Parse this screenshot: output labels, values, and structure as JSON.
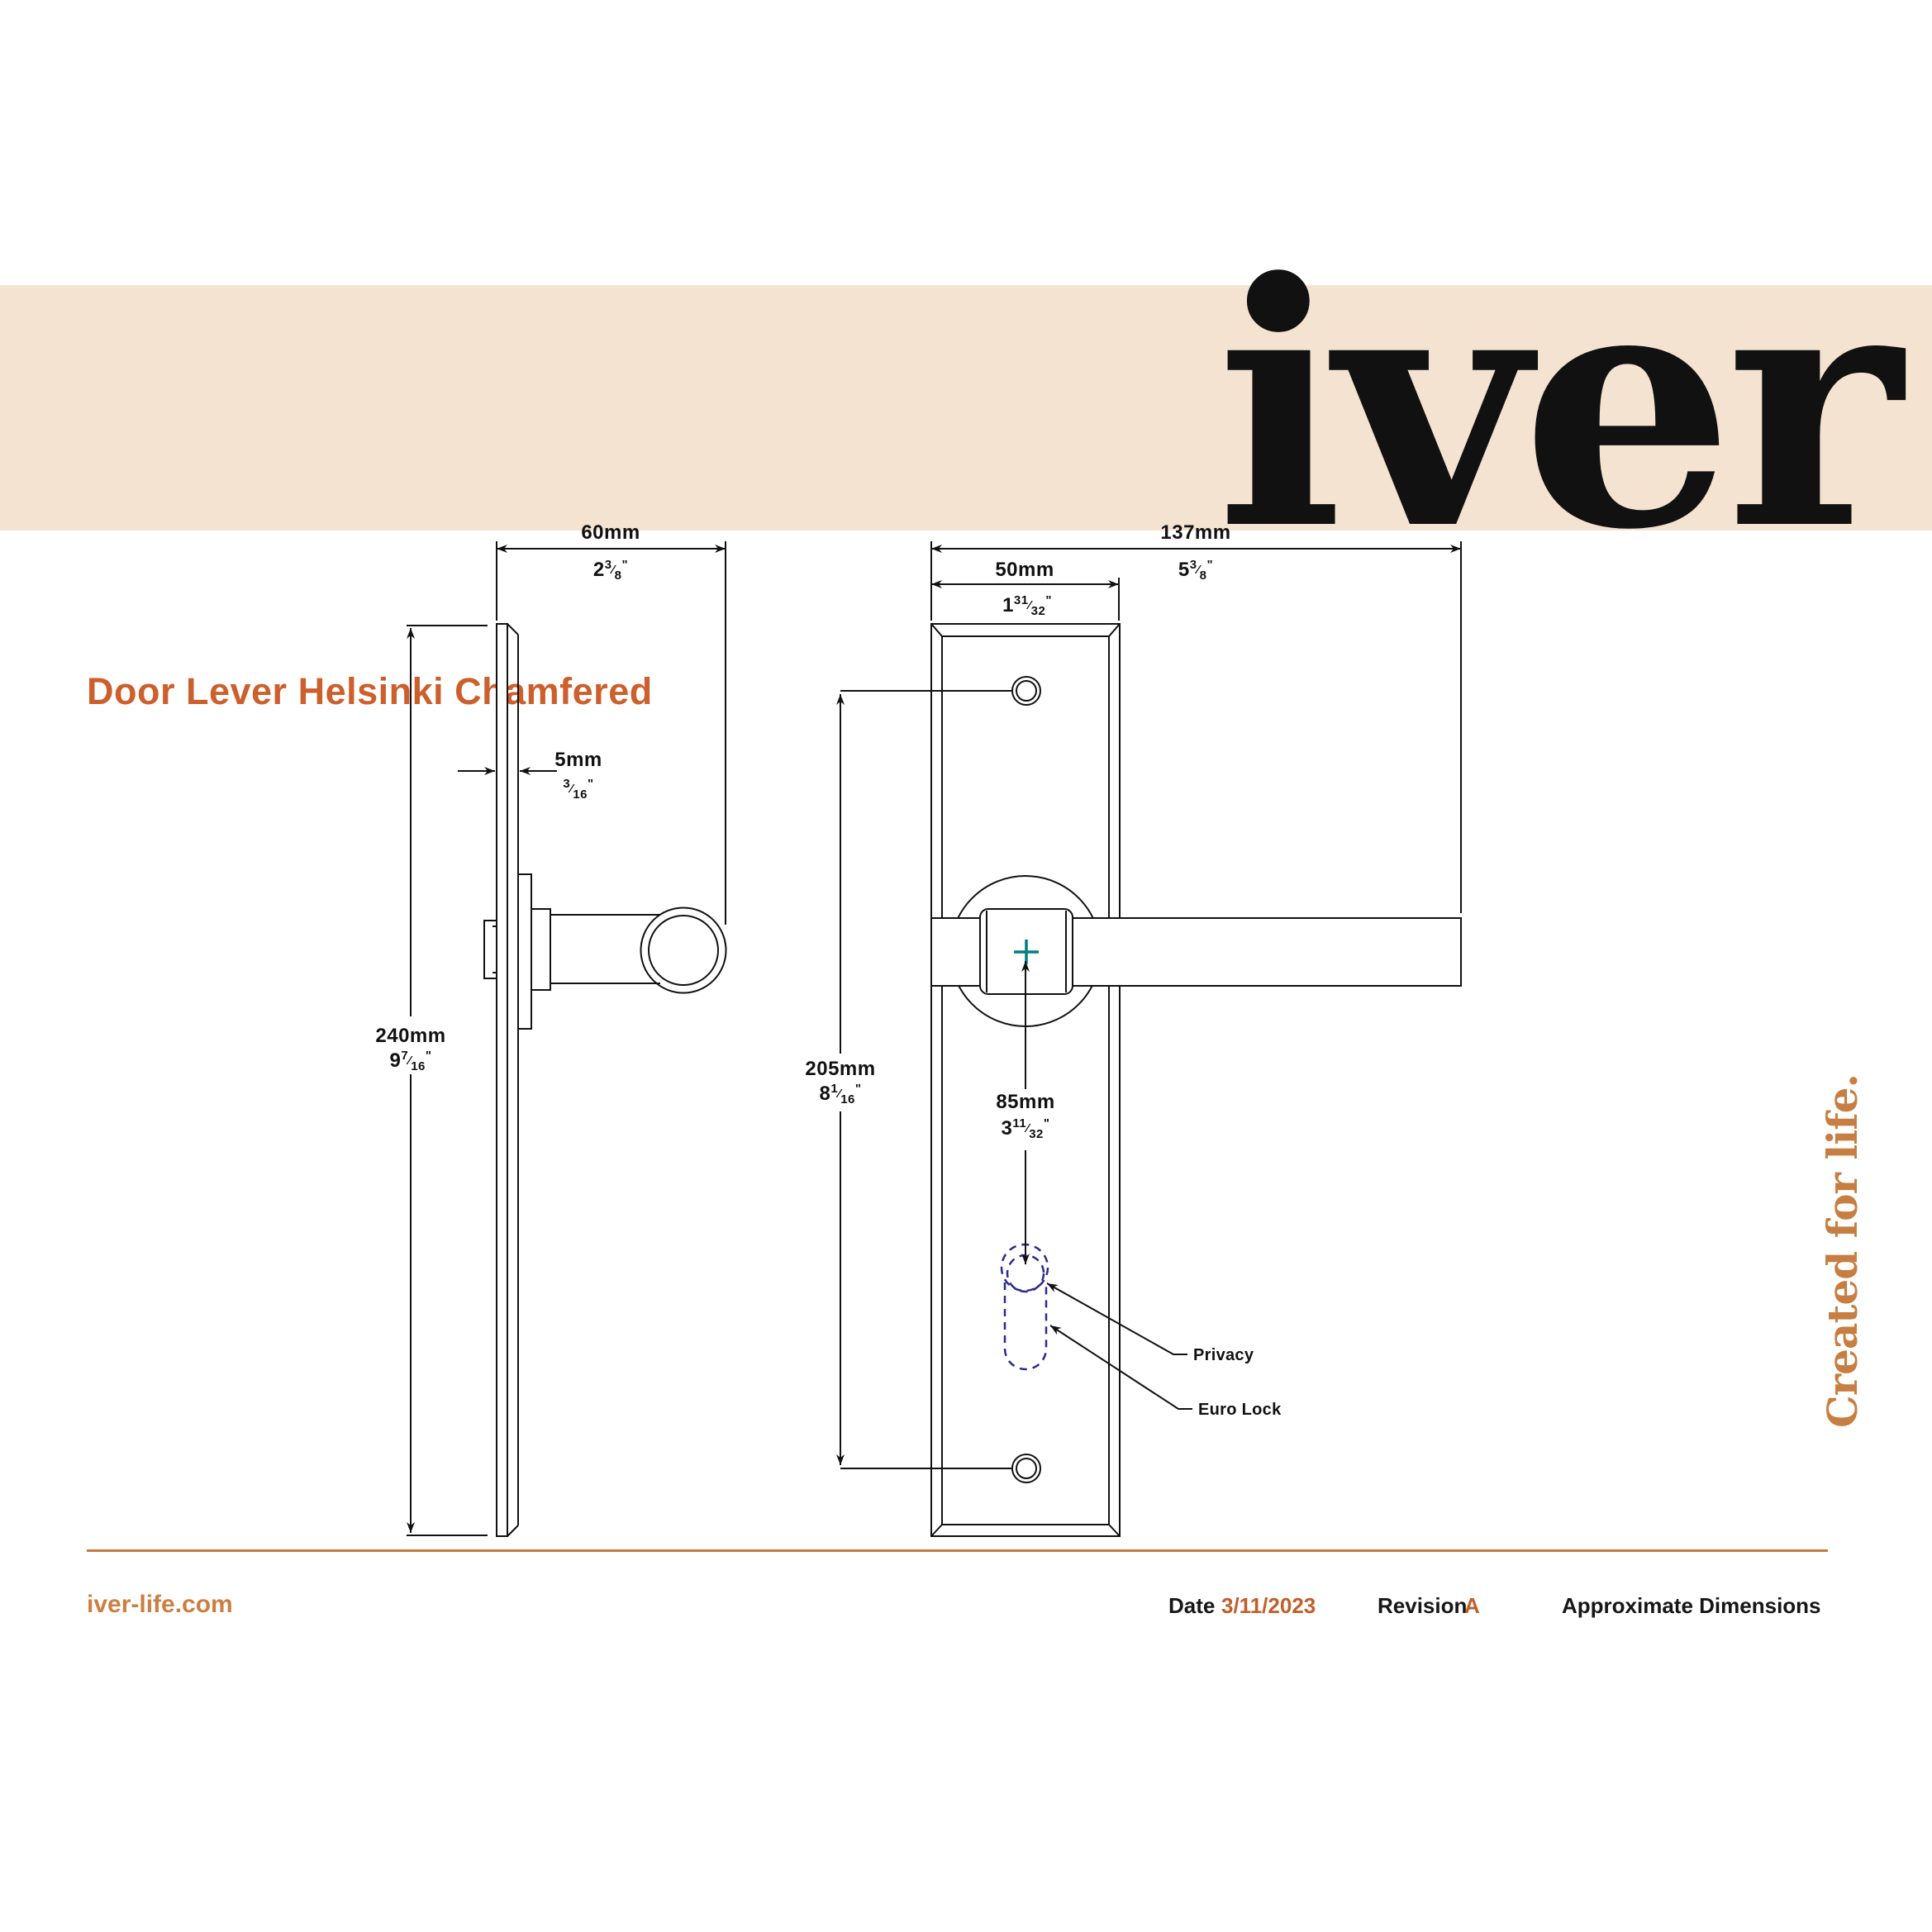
{
  "banner": {
    "title": "Door Lever Helsinki Chamfered",
    "logo": "iver"
  },
  "units": {
    "inch_mark": "\"",
    "frac_slash": "⁄"
  },
  "side_view": {
    "width": {
      "mm": "60mm",
      "whole": "2",
      "num": "3",
      "den": "8"
    },
    "thickness": {
      "mm": "5mm",
      "whole": "",
      "num": "3",
      "den": "16"
    },
    "height": {
      "mm": "240mm",
      "whole": "9",
      "num": "7",
      "den": "16"
    }
  },
  "front_view": {
    "overall_width": {
      "mm": "137mm",
      "whole": "5",
      "num": "3",
      "den": "8"
    },
    "plate_width": {
      "mm": "50mm",
      "whole": "1",
      "num": "31",
      "den": "32"
    },
    "hole_centers": {
      "mm": "205mm",
      "whole": "8",
      "num": "1",
      "den": "16"
    },
    "lock_centre": {
      "mm": "85mm",
      "whole": "3",
      "num": "11",
      "den": "32"
    },
    "labels": {
      "privacy": "Privacy",
      "euro_lock": "Euro Lock"
    }
  },
  "footer": {
    "website": "iver-life.com",
    "date_label": "Date",
    "date_value": "3/11/2023",
    "revision_label": "Revision",
    "revision_value": "A",
    "note": "Approximate Dimensions",
    "tagline": "Created for life."
  },
  "colors": {
    "banner_bg": "#F5E3D1",
    "title_orange": "#CC5F2B",
    "logo_orange": "#C77E42",
    "divider_orange": "#C2793B",
    "footer_accent": "#C06029",
    "line_black": "#111111",
    "dashed_navy": "#2B2B8C",
    "teal_cross": "#007F80"
  }
}
